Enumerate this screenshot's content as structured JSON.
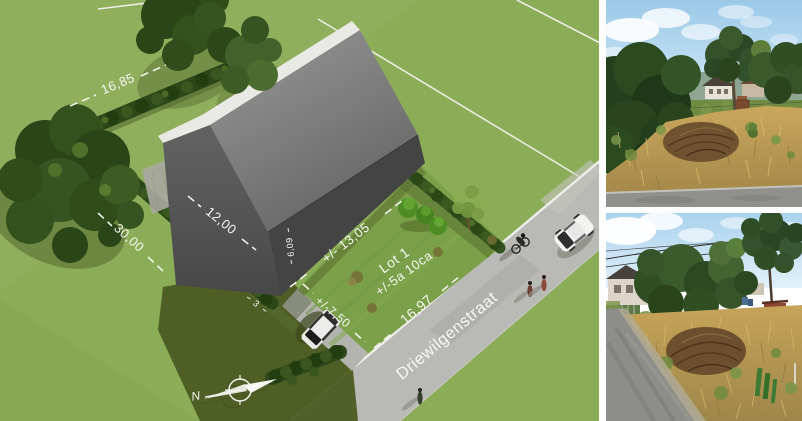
{
  "site_plan": {
    "lot": {
      "name": "Lot 1",
      "area": "+/-5a 10ca"
    },
    "street_name": "Driewilgenstraat",
    "compass_north": "N",
    "dimensions": {
      "rear_boundary": "16,85",
      "left_boundary": "30,00",
      "house_width": "12,00",
      "house_depth": "6,09",
      "side_strip": "3",
      "house_front_length": "+/- 13,05",
      "front_depth": "+/-7,50",
      "street_frontage": "16,97"
    },
    "colors": {
      "grass": "#8cad58",
      "lawn": "#7aa149",
      "hedge": "#2c4719",
      "roof": "#7d7d7d",
      "wall": "#535353",
      "street": "#b9b9b5",
      "dimension_text": "#f7f7f3",
      "divider": "#fdfdfd"
    }
  }
}
